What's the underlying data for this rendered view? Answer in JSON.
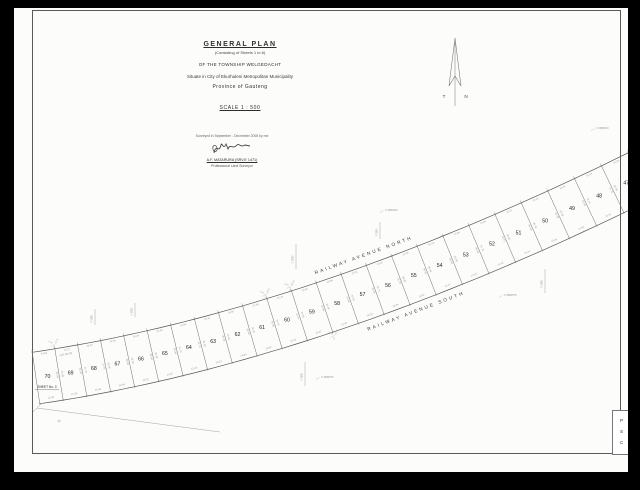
{
  "document": {
    "title_block": {
      "title": "GENERAL PLAN",
      "subtitle": "(Consisting of Sheets 1 to 6)",
      "township_line": "OF THE TOWNSHIP WELGEDACHT",
      "situate_line": "Situate in City of Ekurhuleni Metropolitan Municipality",
      "province_line": "Province of Gauteng",
      "scale_line": "SCALE 1 : 500"
    },
    "survey_block": {
      "surveyed_line": "Surveyed in September - December 2005 by me",
      "surveyor_name": "A.F. MATARURA (SRV.E 1471)",
      "surveyor_title": "Professional Land Surveyor"
    },
    "north_arrow": {
      "left": "T",
      "right": "N"
    },
    "sheet_label": "SHEET No. 3",
    "bearing_note": "(245.00.00)",
    "stamp": {
      "letters": [
        "P",
        "S",
        "C"
      ]
    },
    "streets": {
      "north": "RAILWAY AVENUE NORTH",
      "south": "RAILWAY AVENUE SOUTH"
    },
    "strip": {
      "plots": [
        "70",
        "69",
        "68",
        "67",
        "66",
        "65",
        "64",
        "63",
        "62",
        "61",
        "60",
        "59",
        "58",
        "57",
        "56",
        "55",
        "54",
        "53",
        "52",
        "51",
        "50",
        "49",
        "48",
        "47"
      ],
      "top_dims": [
        "14.94",
        "15.31",
        "14.97",
        "12.40",
        "15.24",
        "14.94"
      ],
      "side_dims": [
        "30.38",
        "30.48",
        "30.38",
        "31.75"
      ],
      "cluster_dims": [
        "2.31",
        "2.04",
        "12.19",
        "0.76"
      ]
    },
    "grid_marks": [
      {
        "x": 366,
        "y": 214,
        "len": 17,
        "v": "Y 2880",
        "h": "X 2880000",
        "hx": 371,
        "hy": 203
      },
      {
        "x": 282,
        "y": 236,
        "len": 25,
        "v": "Y 2880",
        "h": "",
        "hx": 0,
        "hy": 0
      },
      {
        "x": 291,
        "y": 354,
        "len": 24,
        "v": "Y 2880",
        "h": "X 2880575",
        "hx": 307,
        "hy": 370
      },
      {
        "x": 531,
        "y": 261,
        "len": 24,
        "v": "Y 2880",
        "h": "",
        "hx": 0,
        "hy": 0
      },
      {
        "x": -1,
        "y": 0,
        "len": 0,
        "v": "",
        "h": "X 2880575",
        "hx": 490,
        "hy": 288
      },
      {
        "x": -1,
        "y": 0,
        "len": 0,
        "v": "",
        "h": "X 2880000",
        "hx": 582,
        "hy": 121
      },
      {
        "x": 81,
        "y": 301,
        "len": 16,
        "v": "Y 2880",
        "h": "",
        "hx": 0,
        "hy": 0
      },
      {
        "x": 121,
        "y": 295,
        "len": 14,
        "v": "Y 2880",
        "h": "",
        "hx": 0,
        "hy": 0
      }
    ],
    "colors": {
      "paper": "#fcfcfb",
      "ink": "#2e2e2e",
      "line": "#666666",
      "micro": "#999999"
    }
  }
}
